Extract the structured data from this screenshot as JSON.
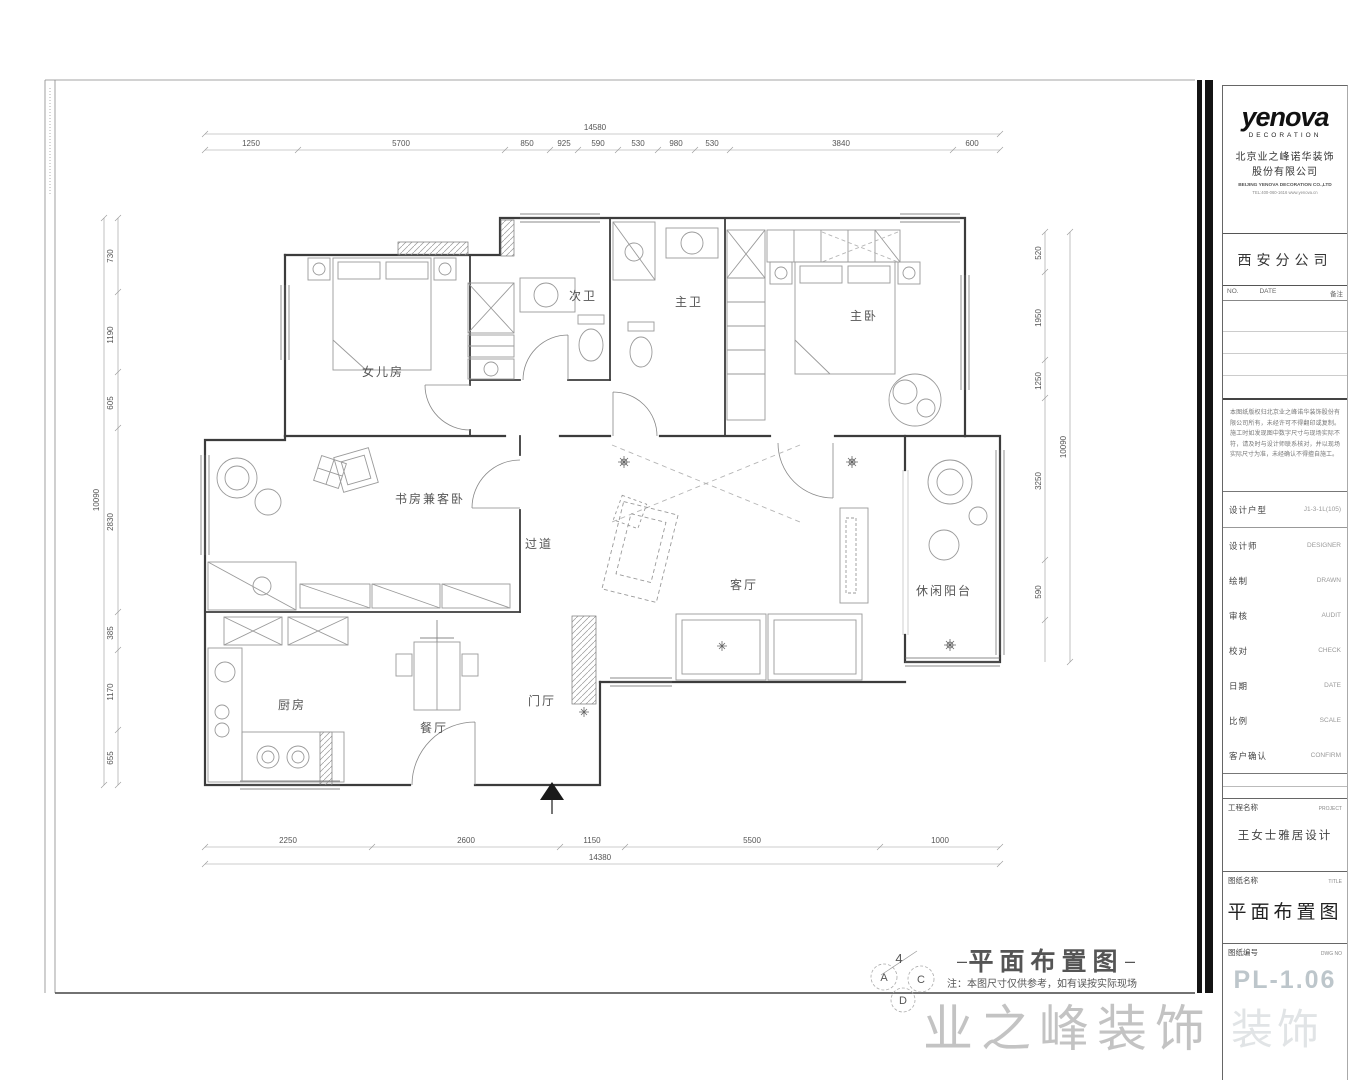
{
  "title_block": {
    "brand": "yenova",
    "brand_sub": "DECORATION",
    "company_cn1": "北京业之峰诺华装饰",
    "company_cn2": "股份有限公司",
    "company_en": "BEIJING YENOVA DECORATION CO.,LTD",
    "company_info": "TEL:400-060-1616  www.yenova.cn",
    "branch": "西安分公司",
    "rev": {
      "no": "NO.",
      "date": "DATE",
      "remark": "备注"
    },
    "notes": "本图纸版权归北京业之峰诺华装饰股份有限公司所有，未经许可不得翻印或复制。施工时如发现图中数字尺寸与现场实际不符，请及时与设计师联系核对，并以现场实际尺寸为准，未经确认不得擅自施工。",
    "fields": [
      {
        "label": "设计户型",
        "value": "J1-3-1L(105)"
      },
      {
        "label": "设计师",
        "value": "DESIGNER"
      },
      {
        "label": "绘制",
        "value": "DRAWN"
      },
      {
        "label": "审核",
        "value": "AUDIT"
      },
      {
        "label": "校对",
        "value": "CHECK"
      },
      {
        "label": "日期",
        "value": "DATE"
      },
      {
        "label": "比例",
        "value": "SCALE"
      },
      {
        "label": "客户确认",
        "value": "CONFIRM"
      }
    ],
    "project": {
      "label": "工程名称",
      "en": "PROJECT",
      "value": "王女士雅居设计"
    },
    "drawing": {
      "label": "图纸名称",
      "en": "TITLE",
      "value": "平面布置图"
    },
    "number": {
      "label": "图纸编号",
      "en": "DWG NO",
      "value": "PL-1.06"
    },
    "watermark": "装饰"
  },
  "plan": {
    "rooms": [
      "女儿房",
      "次卫",
      "主卫",
      "主卧",
      "书房兼客卧",
      "过道",
      "客厅",
      "休闲阳台",
      "厨房",
      "餐厅",
      "门厅"
    ],
    "title": "平面布置图",
    "dash_left": "–",
    "dash_right": "–",
    "note": "注：本图尺寸仅供参考，如有误按实际现场",
    "markers": {
      "num": "4",
      "a": "A",
      "c": "C",
      "d": "D"
    },
    "watermark": "业之峰装饰",
    "dims": {
      "top": {
        "total": "14580",
        "segments": [
          "1250",
          "5700",
          "850",
          "925",
          "590",
          "530",
          "980",
          "530",
          "3840",
          "600"
        ]
      },
      "bottom": {
        "total": "14380",
        "segments": [
          "2250",
          "2600",
          "1150",
          "5500",
          "1000"
        ]
      },
      "left": {
        "total": "10090",
        "segments": [
          "730",
          "1190",
          "605",
          "2830",
          "385",
          "1170",
          "655"
        ]
      },
      "right": {
        "total": "10090",
        "segments": [
          "520",
          "1950",
          "1250",
          "3250",
          "590"
        ]
      }
    }
  }
}
